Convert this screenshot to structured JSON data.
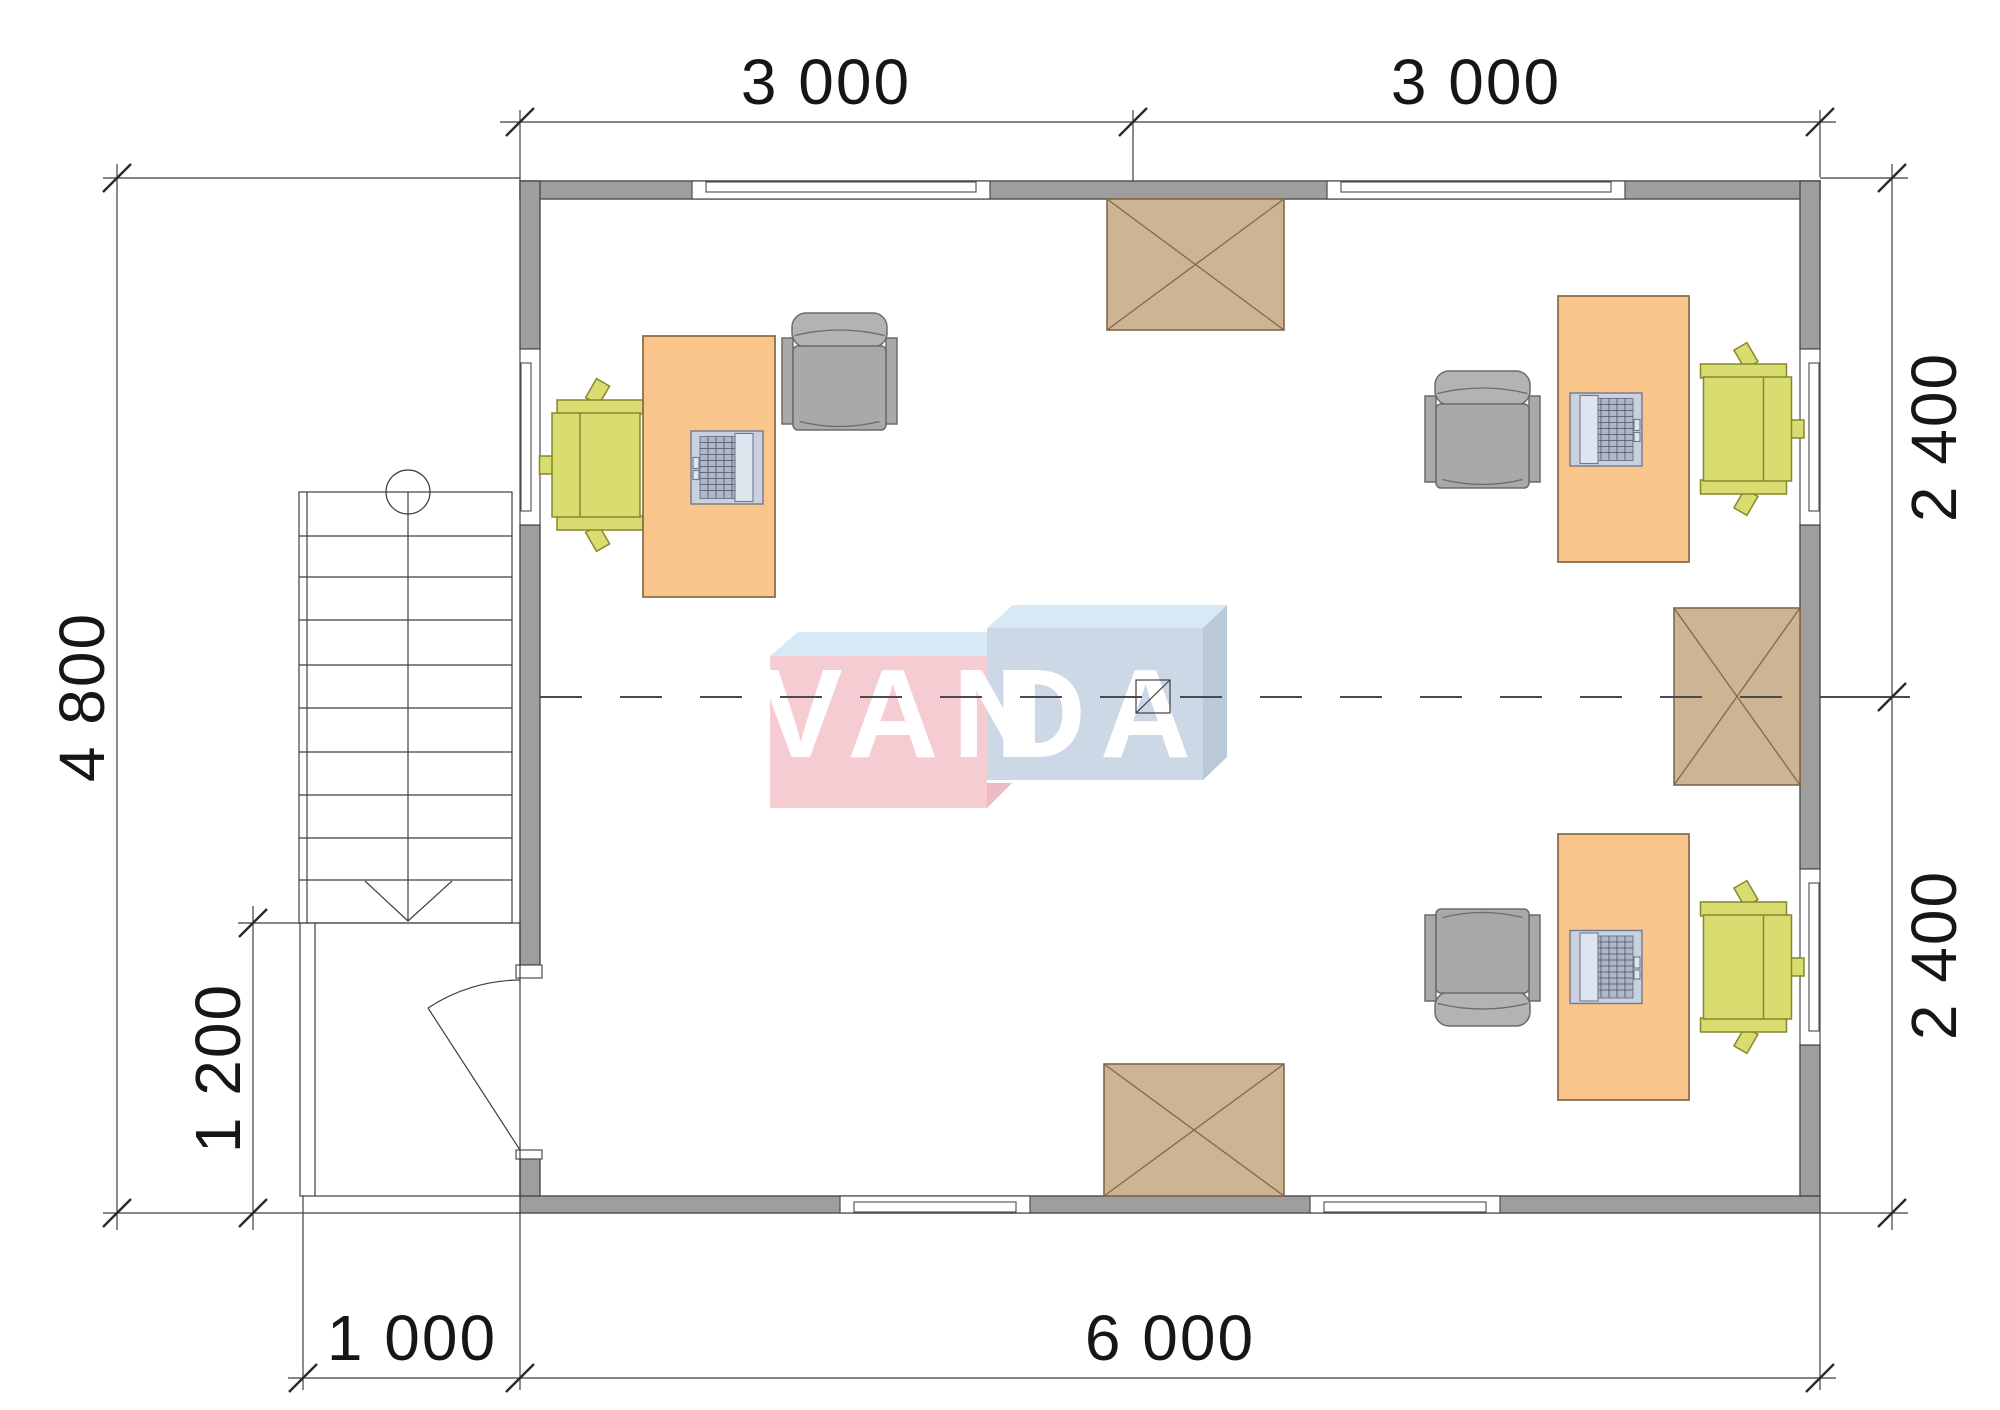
{
  "floor_plan": {
    "dimensions": {
      "top_left_span": "3 000",
      "top_right_span": "3 000",
      "right_upper_span": "2 400",
      "right_lower_span": "2 400",
      "left_total": "4 800",
      "porch_height": "1 200",
      "bottom_porch": "1 000",
      "bottom_total": "6 000"
    },
    "watermark": {
      "left_text": "VAN",
      "right_text": "DA",
      "pink_hex": "#f6ccd3",
      "blue_hex": "#ccd8e5",
      "top_face_hex": "#d6e9f4"
    },
    "colors": {
      "wall": "#9e9e9e",
      "desk": "#f9c58b",
      "task_chair": "#d9dd6f",
      "armchair": "#a9a9a9",
      "crate": "#cdb494",
      "line": "#3f3f3f"
    }
  }
}
